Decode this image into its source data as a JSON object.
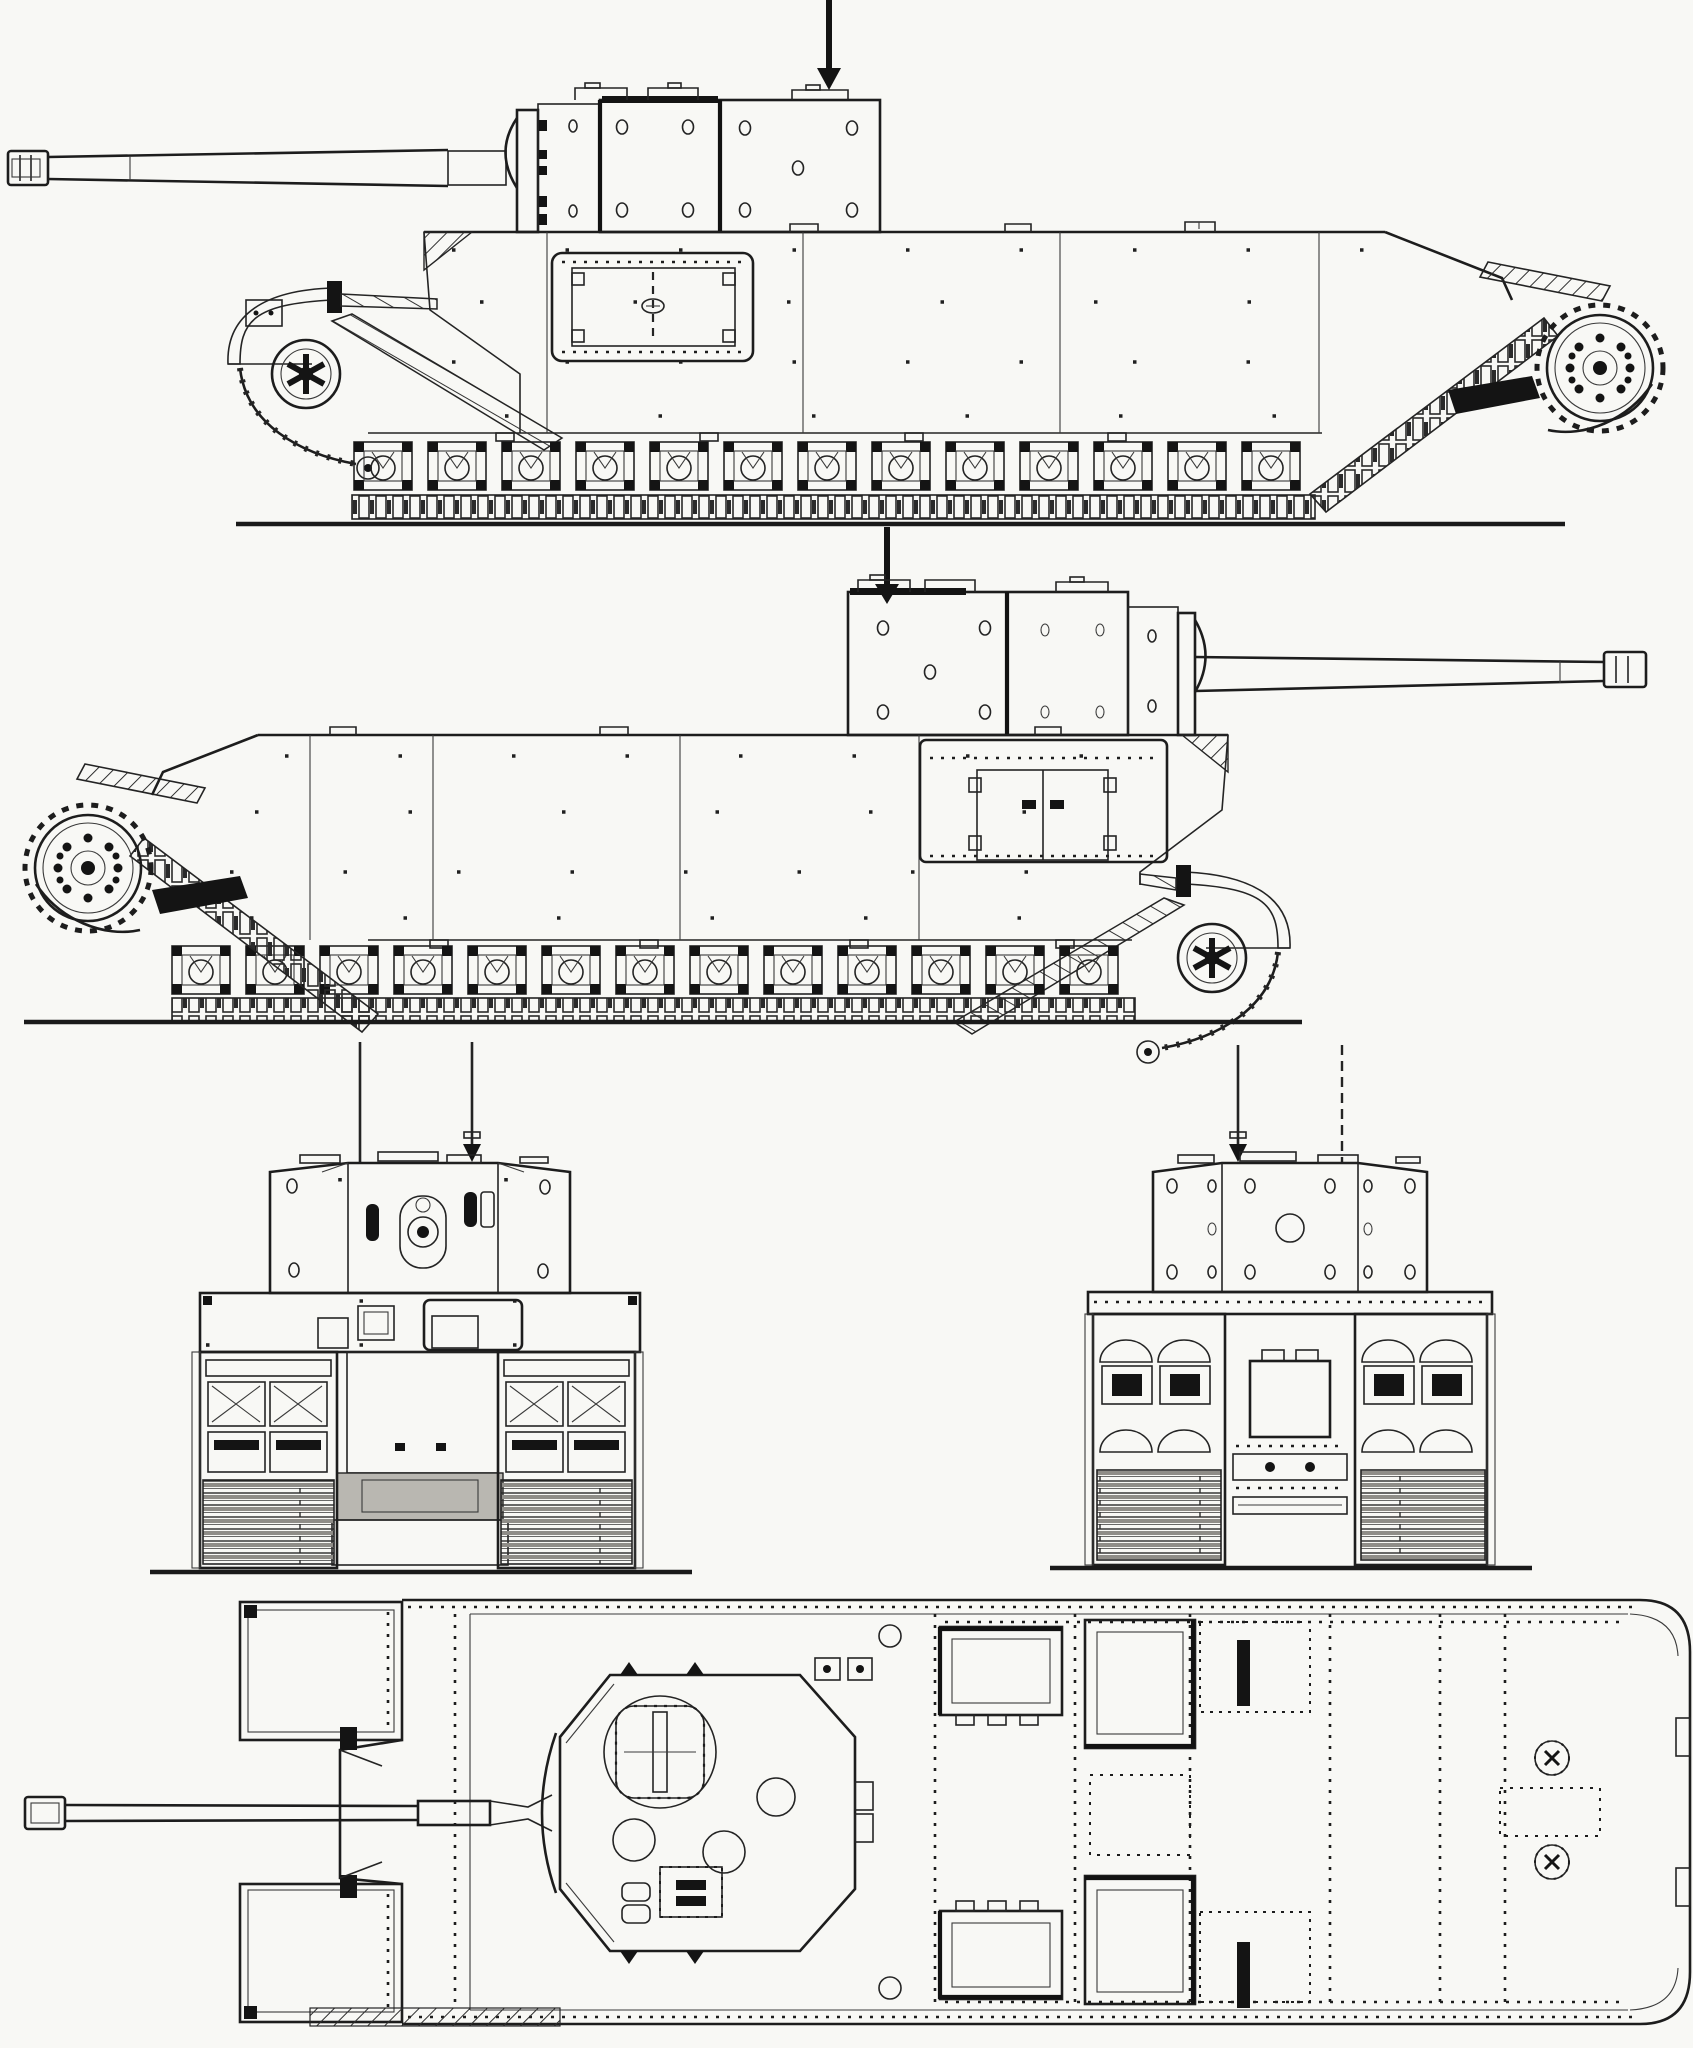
{
  "canvas": {
    "background": "#f8f8f5",
    "ink": "#242424",
    "dark_fill": "#141414",
    "shade_gray": "#b9b7b1",
    "drawing_style": "monochrome riveted-armour blueprint, five orthographic views of a heavy tank"
  },
  "views": {
    "side_left": {
      "label": "Side elevation, gun facing left"
    },
    "side_right": {
      "label": "Side elevation, gun facing right"
    },
    "front": {
      "label": "Front elevation"
    },
    "rear": {
      "label": "Rear elevation"
    },
    "plan": {
      "label": "Top plan view, gun facing left"
    }
  },
  "icons": {
    "direction_arrow": "solid downward arrow marker above each turret",
    "rivet_dot": "small square rivet dots along armour plate seams",
    "sprocket_wheel": "drive sprocket with twelve-bolt circle",
    "idler_wheel": "spoked idler wheel at hull front",
    "track_bogie": "repeating suspension bogie unit",
    "hatch_plate": "rounded rectangular access hatch with hinge tabs"
  }
}
